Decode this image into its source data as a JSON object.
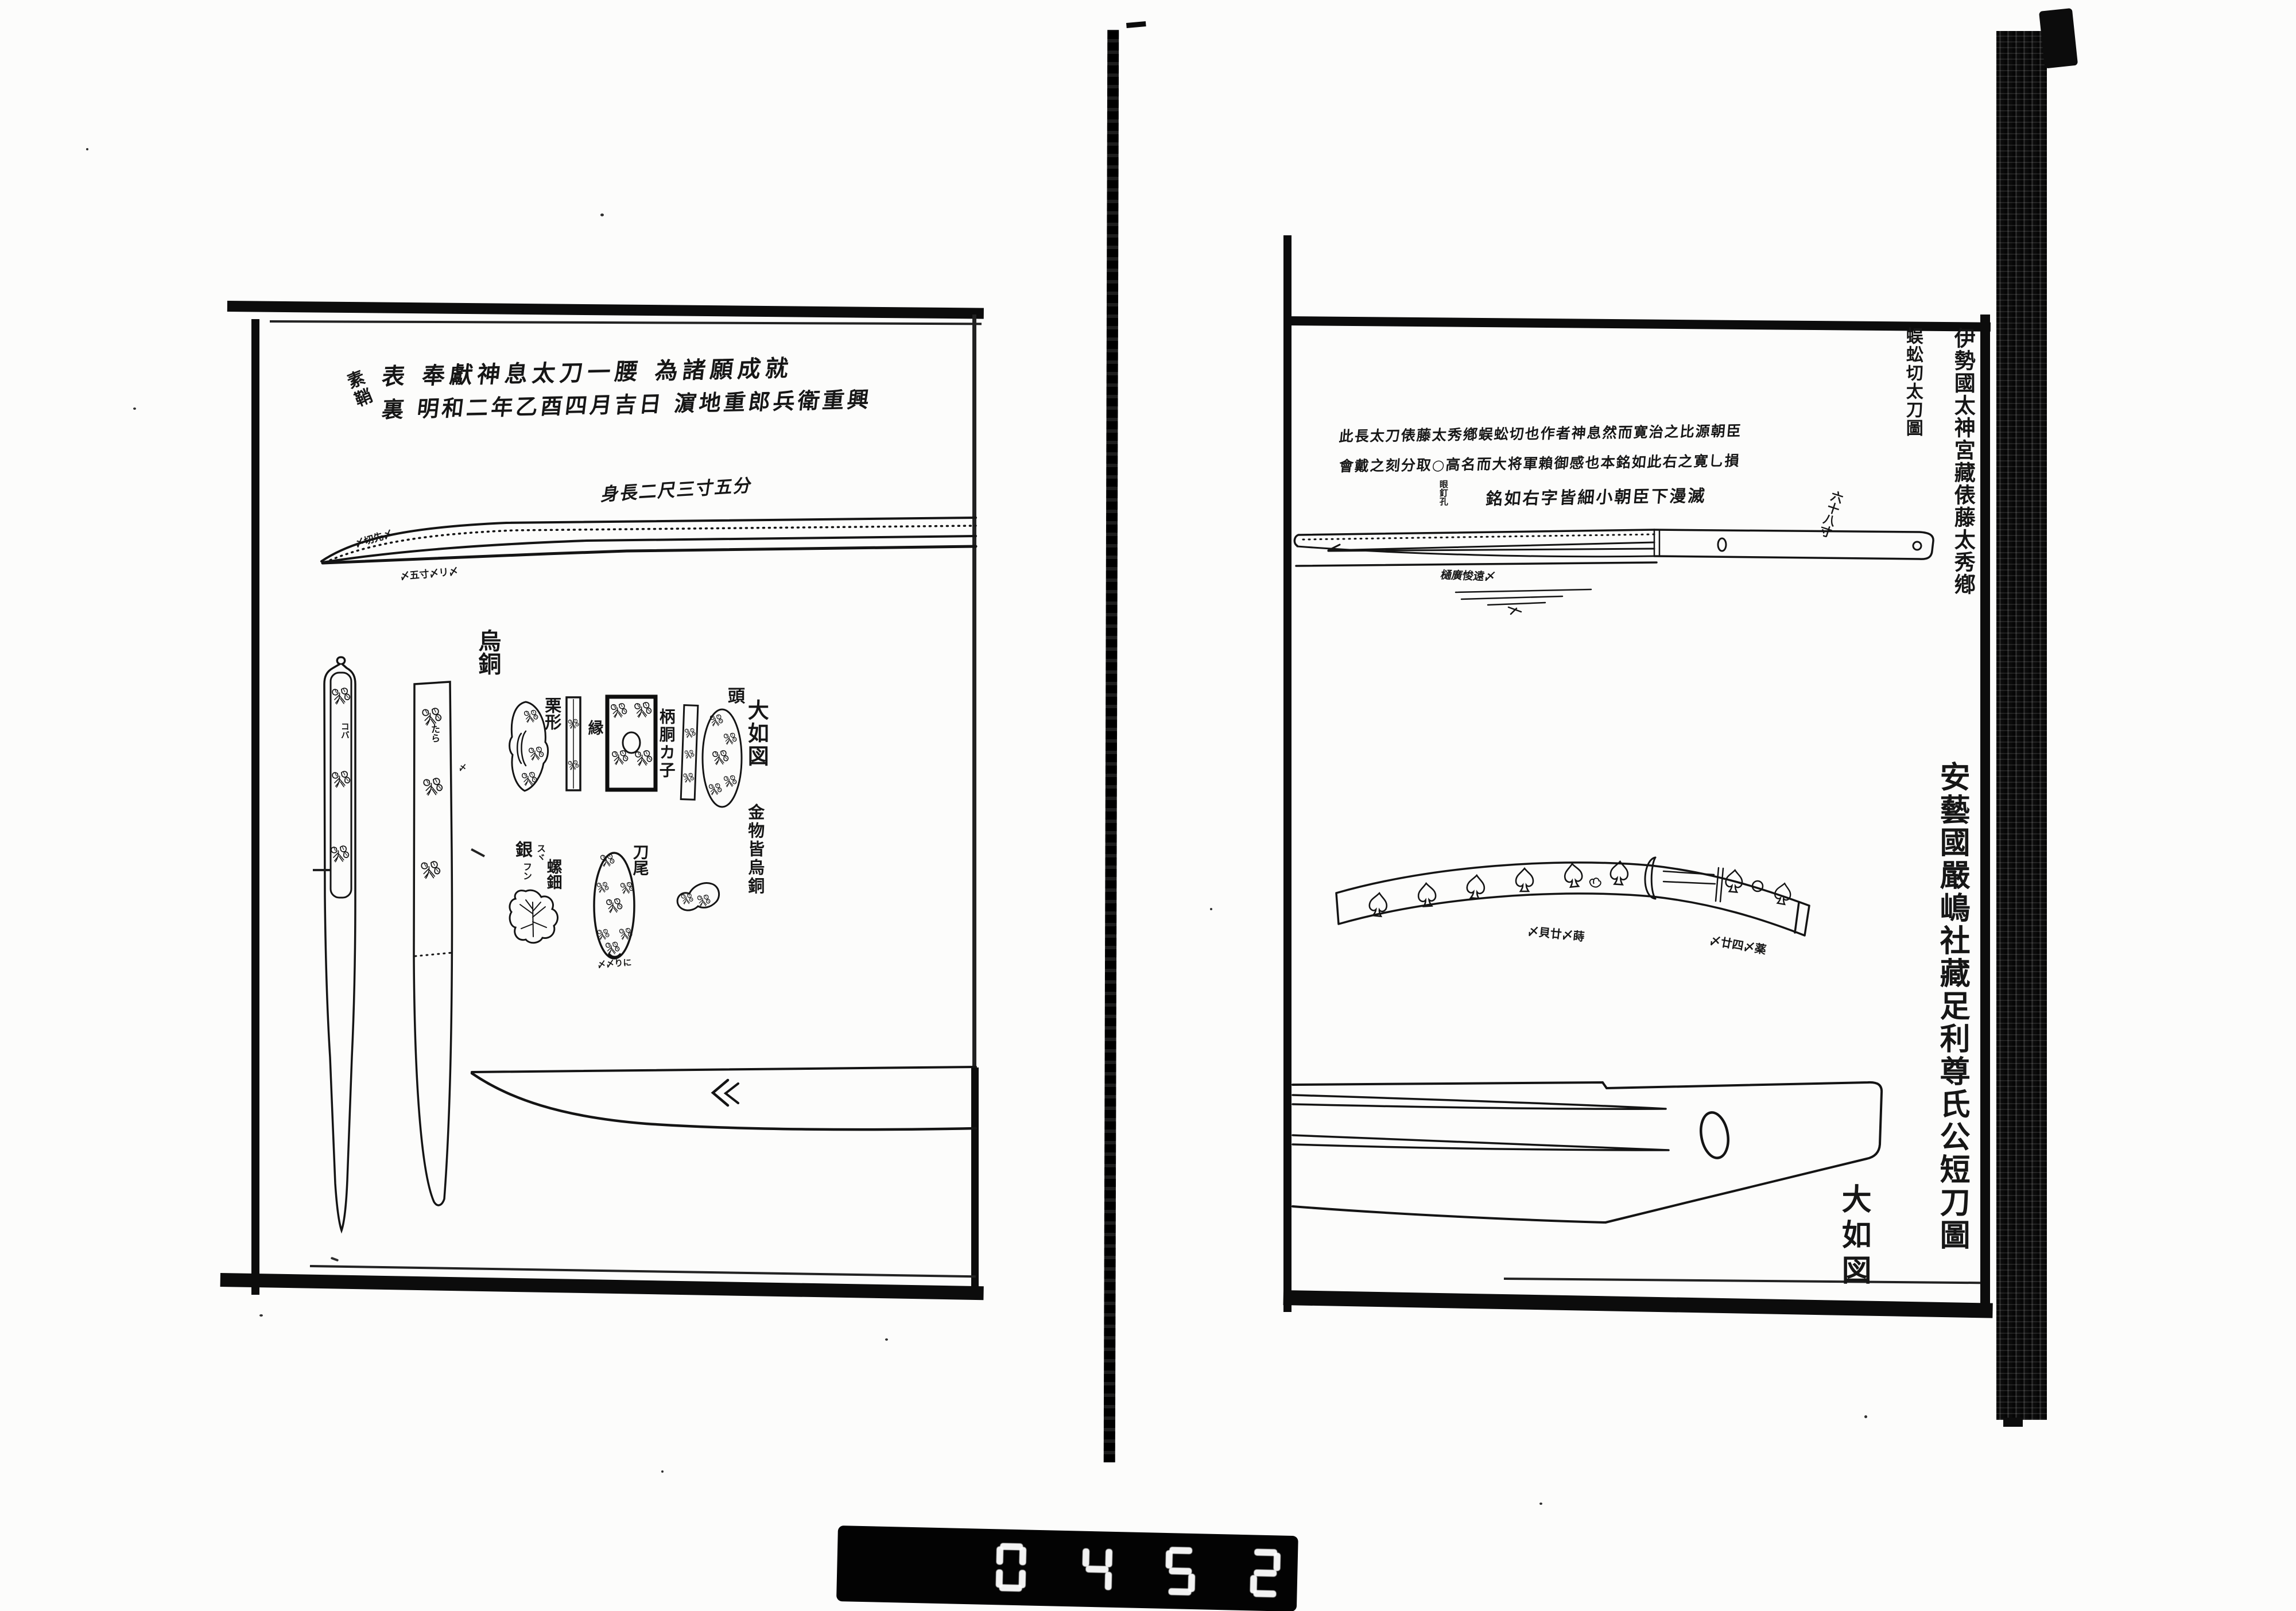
{
  "scan": {
    "plate": {
      "digits": "0452"
    },
    "left_page": {
      "saya_note": "素鞘",
      "omote_line": "表 奉獻神息太刀一腰 為諸願成就",
      "ura_line": "裏 明和二年乙酉四月吉日 濵地重郎兵衛重興",
      "blade_length_note": "身長二尺三寸五分",
      "tip_note": "〆切先〆",
      "edge_note": "〆五寸〆リ〆",
      "karasu_gane": "烏銅",
      "kurikata": "栗形",
      "fuchi": "縁",
      "tsuka_do_kane": "柄胴カ子",
      "kashira": "頭",
      "size_note": "大如図",
      "fittings_note": "金物皆烏銅",
      "silver_note": "銀",
      "silver_kana_1": "スヾ",
      "silver_kana_2": "フン",
      "raden": "螺鈿",
      "kojiri": "刀尾",
      "hilt_marks": "コバ",
      "saya_marks": "たら",
      "saya_side_mark": "〆",
      "kojiri_scribble": "〆〆りに"
    },
    "right_page": {
      "margin_title_main": "伊勢國太神宮藏俵藤太秀鄕",
      "margin_title_sub": "蜈蚣切太刀圖",
      "header_row_1": "此長太刀俵藤太秀鄕蜈蚣切也作者神息然而寛治之比源朝臣",
      "header_row_2": "會戴之刻分取○高名而大将軍賴御感也本銘如此右之寛乚損",
      "header_row_3": "銘如右字皆細小朝臣下漫滅",
      "peg_hole_note": "眼釘孔",
      "length_note": "六十八寸",
      "blade_note": "樋廣悛遠〆",
      "mount_note_left": "〆貝廿〆蒔",
      "mount_note_right": "〆廿四〆薬",
      "size_note": "大如図",
      "lower_margin_title": "安藝國嚴嶋社藏足利尊氏公短刀圖"
    }
  }
}
